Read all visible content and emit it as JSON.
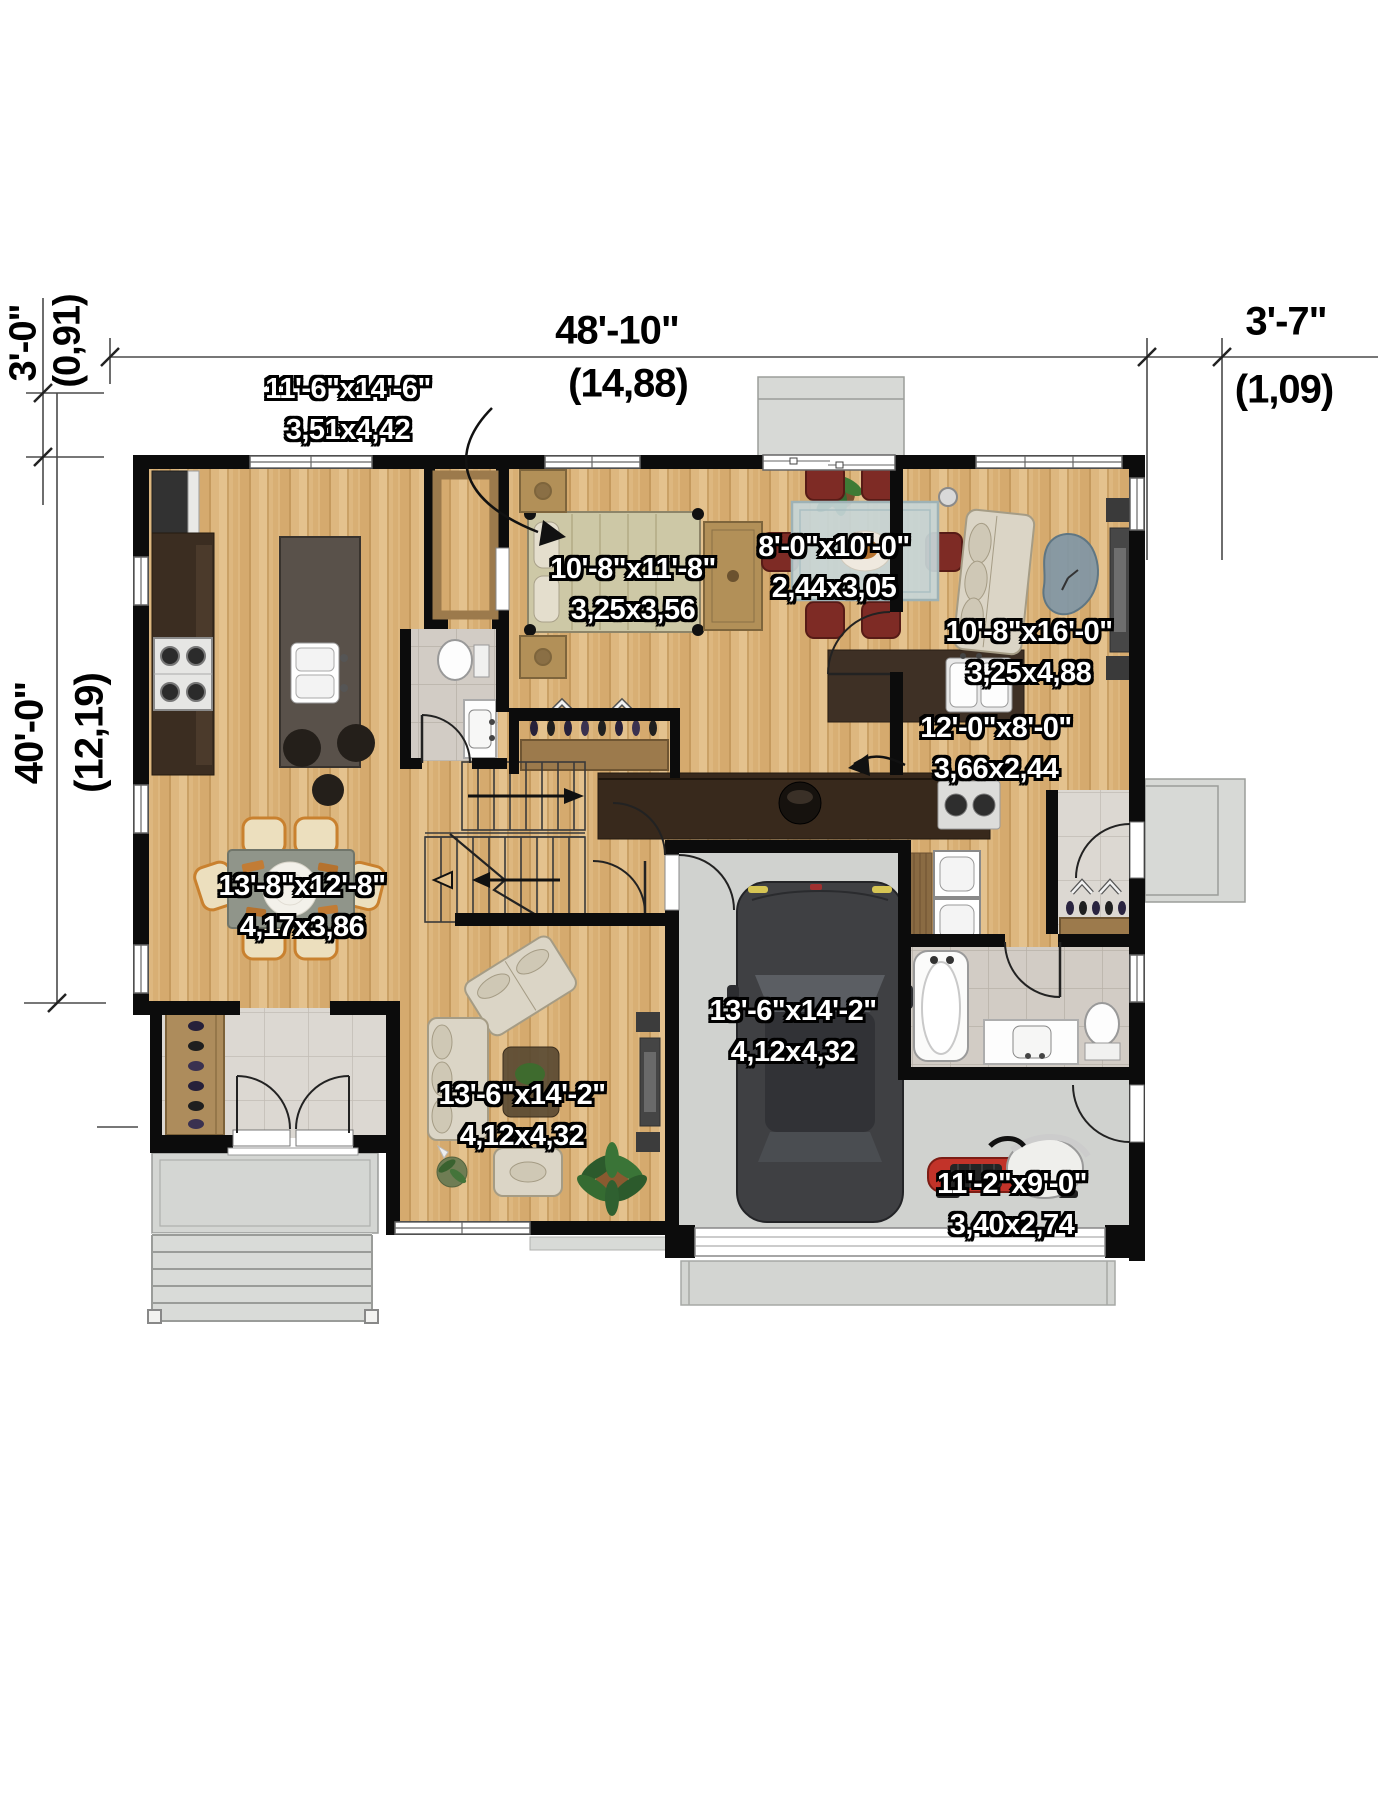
{
  "plan": {
    "dimensions": {
      "overall_width": {
        "imperial": "48'-10\"",
        "metric": "(14,88)"
      },
      "right_offset": {
        "imperial": "3'-7\"",
        "metric": "(1,09)"
      },
      "rear_offset": {
        "imperial": "3'-0\"",
        "metric": "(0,91)"
      },
      "overall_depth": {
        "imperial": "40'-0\"",
        "metric": "(12,19)"
      }
    },
    "rooms": {
      "kitchen": {
        "imperial": "11'-6\"x14'-6\"",
        "metric": "3,51x4,42"
      },
      "bedroom": {
        "imperial": "10'-8\"x11'-8\"",
        "metric": "3,25x3,56"
      },
      "dining_nook": {
        "imperial": "8'-0\"x10'-0\"",
        "metric": "2,44x3,05"
      },
      "living_upper": {
        "imperial": "10'-8\"x16'-0\"",
        "metric": "3,25x4,88"
      },
      "kitchen_counter": {
        "imperial": "12'-0\"x8'-0\"",
        "metric": "3,66x2,44"
      },
      "dining_room": {
        "imperial": "13'-8\"x12'-8\"",
        "metric": "4,17x3,86"
      },
      "garage": {
        "imperial": "13'-6\"x14'-2\"",
        "metric": "4,12x4,32"
      },
      "living_room": {
        "imperial": "13'-6\"x14'-2\"",
        "metric": "4,12x4,32"
      },
      "storage": {
        "imperial": "11'-2\"x9'-0\"",
        "metric": "3,40x2,74"
      }
    },
    "colors": {
      "wall": "#0c0c0c",
      "wood_floor": "#dcb478",
      "concrete": "#d4d6d3",
      "tile": "#d9d4ce",
      "counter_dark": "#38291c",
      "island": "#59514a",
      "chair_red": "#7e2b25",
      "chair_cream": "#ecdfbe",
      "sofa_beige": "#dbd5c6",
      "coffee_table_blue": "#8096a5",
      "car_gray": "#3f4043",
      "tractor_red": "#c23329",
      "label_text": "#ffffff",
      "dimension_text": "#000000"
    }
  }
}
